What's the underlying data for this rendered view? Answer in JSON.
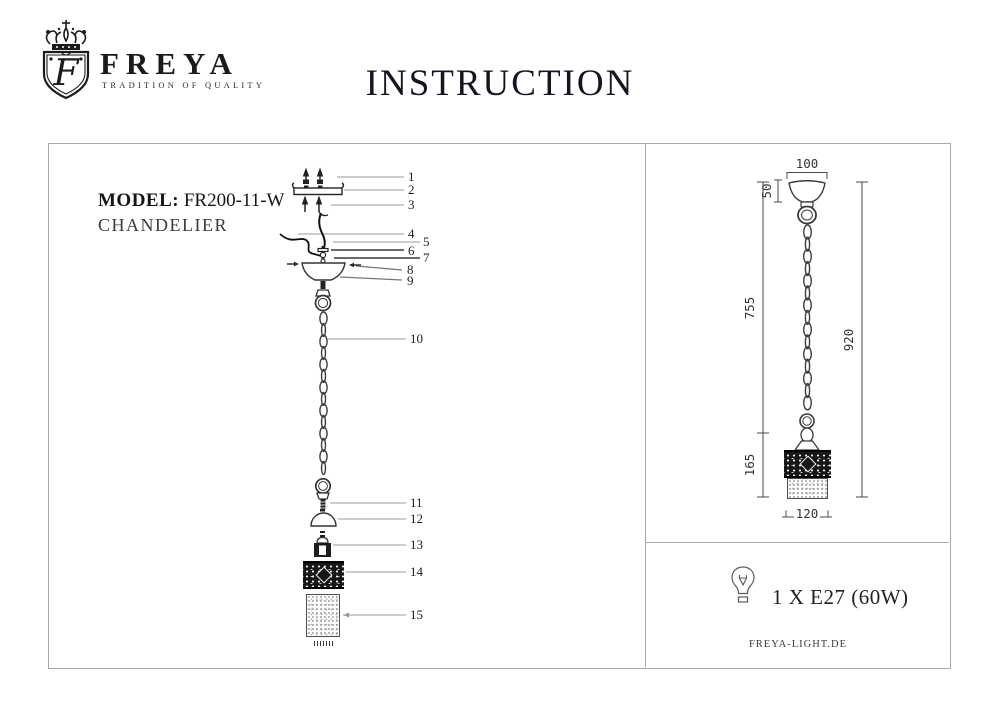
{
  "brand": {
    "name": "FREYA",
    "tagline": "TRADITION OF QUALITY",
    "monogram": "F"
  },
  "title": "INSTRUCTION",
  "product": {
    "model_label": "MODEL:",
    "model": "FR200-11-W",
    "type": "CHANDELIER"
  },
  "callouts": [
    "1",
    "2",
    "3",
    "4",
    "5",
    "6",
    "7",
    "8",
    "9",
    "10",
    "11",
    "12",
    "13",
    "14",
    "15"
  ],
  "dimensions": {
    "canopy_width": "100",
    "canopy_height": "50",
    "chain_length": "755",
    "total_height": "920",
    "shade_height": "165",
    "shade_width": "120"
  },
  "spec": {
    "bulb": "1 X E27 (60W)",
    "website": "FREYA-LIGHT.DE"
  },
  "colors": {
    "ink": "#1c1c1c",
    "callout_line": "#9a9a9a",
    "drawing": "#3d3d3d",
    "frame": "#a9a9a9"
  }
}
